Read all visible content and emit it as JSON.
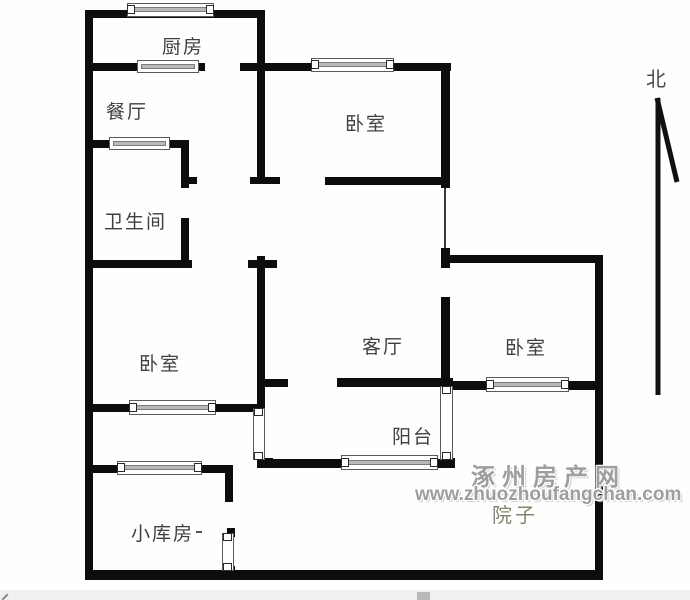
{
  "floorplan": {
    "north_label": "北",
    "rooms": [
      {
        "id": "kitchen",
        "label": "厨房"
      },
      {
        "id": "dining",
        "label": "餐厅"
      },
      {
        "id": "bathroom",
        "label": "卫生间"
      },
      {
        "id": "bedroom_top",
        "label": "卧室"
      },
      {
        "id": "bedroom_left",
        "label": "卧室"
      },
      {
        "id": "living",
        "label": "客厅"
      },
      {
        "id": "bedroom_right",
        "label": "卧室"
      },
      {
        "id": "balcony",
        "label": "阳台"
      },
      {
        "id": "storage",
        "label": "小库房"
      },
      {
        "id": "yard",
        "label": "院子"
      }
    ]
  },
  "watermark": {
    "site_name": "涿州房产网",
    "site_url": "www.zhuozhoufangchan.com"
  },
  "colors": {
    "wall": "#0d0d0d",
    "label_text": "#3f3f3f",
    "watermark_text": "#9e9e9e",
    "yard_label_text": "#83836c",
    "window_glass": "#b9b9b9",
    "bottom_bar": "#f0f0f0"
  }
}
